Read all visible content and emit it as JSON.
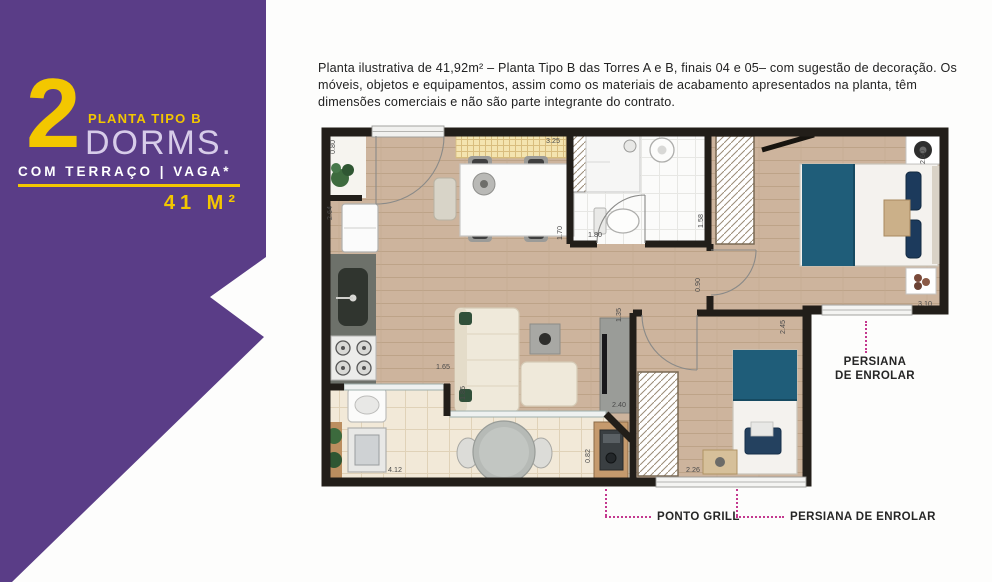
{
  "banner": {
    "number": "2",
    "kicker": "PLANTA TIPO B",
    "title": "DORMS.",
    "subtitle": "COM TERRAÇO | VAGA*",
    "area": "41 M²",
    "colors": {
      "background": "#5a3d87",
      "accent": "#f3c700",
      "title": "#d7cce9",
      "subtitle": "#ffffff"
    }
  },
  "disclaimer": "Planta ilustrativa de 41,92m² – Planta Tipo B das Torres A e B, finais 04 e 05– com sugestão de decoração. Os móveis, objetos e equipamentos, assim como os materiais de acabamento apresentados na planta, têm dimensões comerciais e não são parte integrante do contrato.",
  "floorplan": {
    "dimensions": [
      {
        "value": "0.80",
        "x": 17,
        "y": 32,
        "rot": -90
      },
      {
        "value": "3.25",
        "x": 228,
        "y": 21,
        "rot": 0
      },
      {
        "value": "2.60",
        "x": 607,
        "y": 42,
        "rot": -90
      },
      {
        "value": "2.64",
        "x": 14,
        "y": 98,
        "rot": -90
      },
      {
        "value": "1.70",
        "x": 244,
        "y": 118,
        "rot": -90
      },
      {
        "value": "1.80",
        "x": 270,
        "y": 115,
        "rot": 0
      },
      {
        "value": "1.58",
        "x": 385,
        "y": 106,
        "rot": -90
      },
      {
        "value": "0.90",
        "x": 382,
        "y": 170,
        "rot": -90
      },
      {
        "value": "3.10",
        "x": 600,
        "y": 184,
        "rot": 0
      },
      {
        "value": "1.35",
        "x": 303,
        "y": 200,
        "rot": -90
      },
      {
        "value": "2.45",
        "x": 467,
        "y": 212,
        "rot": -90
      },
      {
        "value": "1.65",
        "x": 118,
        "y": 247,
        "rot": 0
      },
      {
        "value": "1.85",
        "x": 147,
        "y": 278,
        "rot": -90
      },
      {
        "value": "2.40",
        "x": 294,
        "y": 285,
        "rot": 0
      },
      {
        "value": "4.12",
        "x": 70,
        "y": 350,
        "rot": 0
      },
      {
        "value": "0.82",
        "x": 272,
        "y": 341,
        "rot": -90
      },
      {
        "value": "2.26",
        "x": 368,
        "y": 350,
        "rot": 0
      }
    ],
    "annotations": {
      "persiana_right_line1": "PERSIANA",
      "persiana_right_line2": "DE ENROLAR",
      "ponto_grill": "PONTO GRILL",
      "persiana_bottom": "PERSIANA DE ENROLAR"
    },
    "colors": {
      "wall": "#221e19",
      "wood_floor": "#cdb49d",
      "terrace_floor": "#f2e9d8",
      "bed_cover": "#1f5d79",
      "leader_line": "#c4398f"
    }
  }
}
